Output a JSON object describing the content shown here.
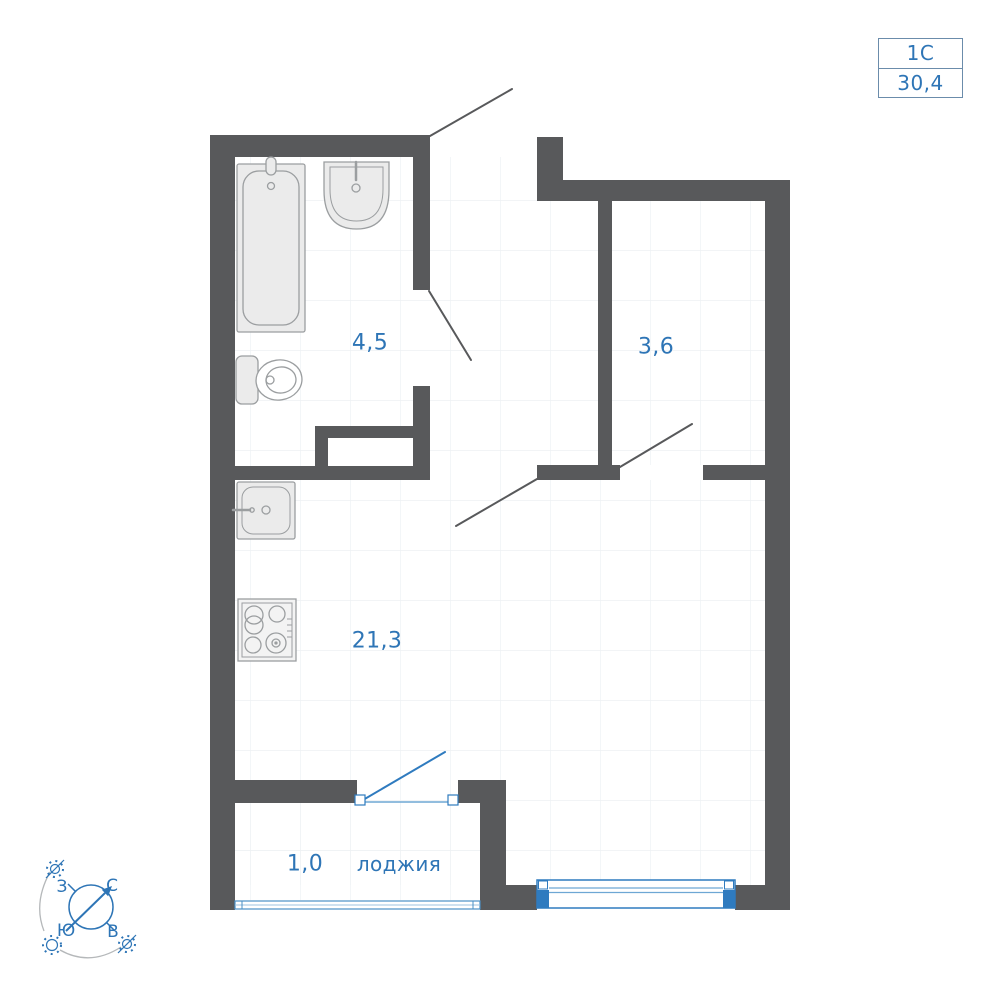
{
  "unit_card": {
    "type_code": "1С",
    "area_value": "30,4"
  },
  "rooms": {
    "bathroom": {
      "area": "4,5"
    },
    "hallway": {
      "area": "3,6"
    },
    "living": {
      "area": "21,3"
    },
    "loggia": {
      "area": "1,0",
      "name": "лоджия"
    }
  },
  "compass": {
    "north": "С",
    "south": "Ю",
    "west": "З",
    "east": "В"
  },
  "colors": {
    "wall": "#58595b",
    "accent_blue": "#2e75b6",
    "window_blue": "#2f7bbf",
    "fixture_fill": "#ebebeb",
    "fixture_stroke": "#9b9ea0",
    "tile_grid": "#eef1f4"
  }
}
